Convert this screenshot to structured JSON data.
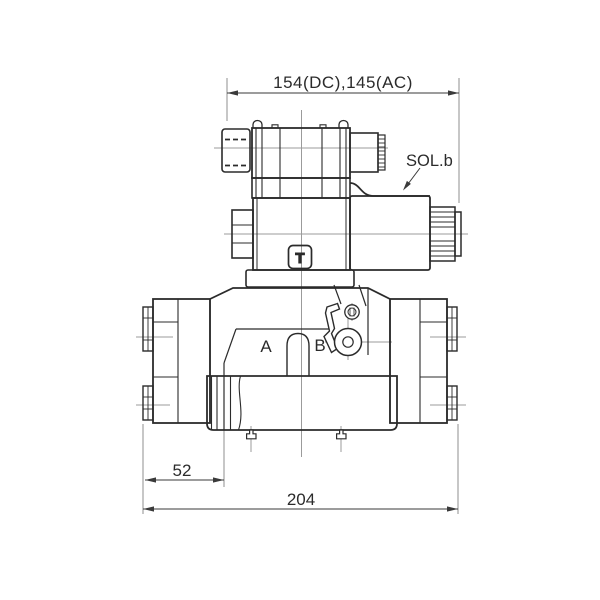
{
  "labels": {
    "dim_top": "154(DC),145(AC)",
    "sol_b": "SOL.b",
    "port_a": "A",
    "port_b": "B",
    "dim_52": "52",
    "dim_204": "204",
    "logo_t": "T"
  },
  "colors": {
    "line": "#2b2b2b",
    "centerline": "#9b9b9b",
    "extension_line": "#8f8f8f",
    "dimension": "#3a3a3a",
    "background": "#ffffff"
  }
}
